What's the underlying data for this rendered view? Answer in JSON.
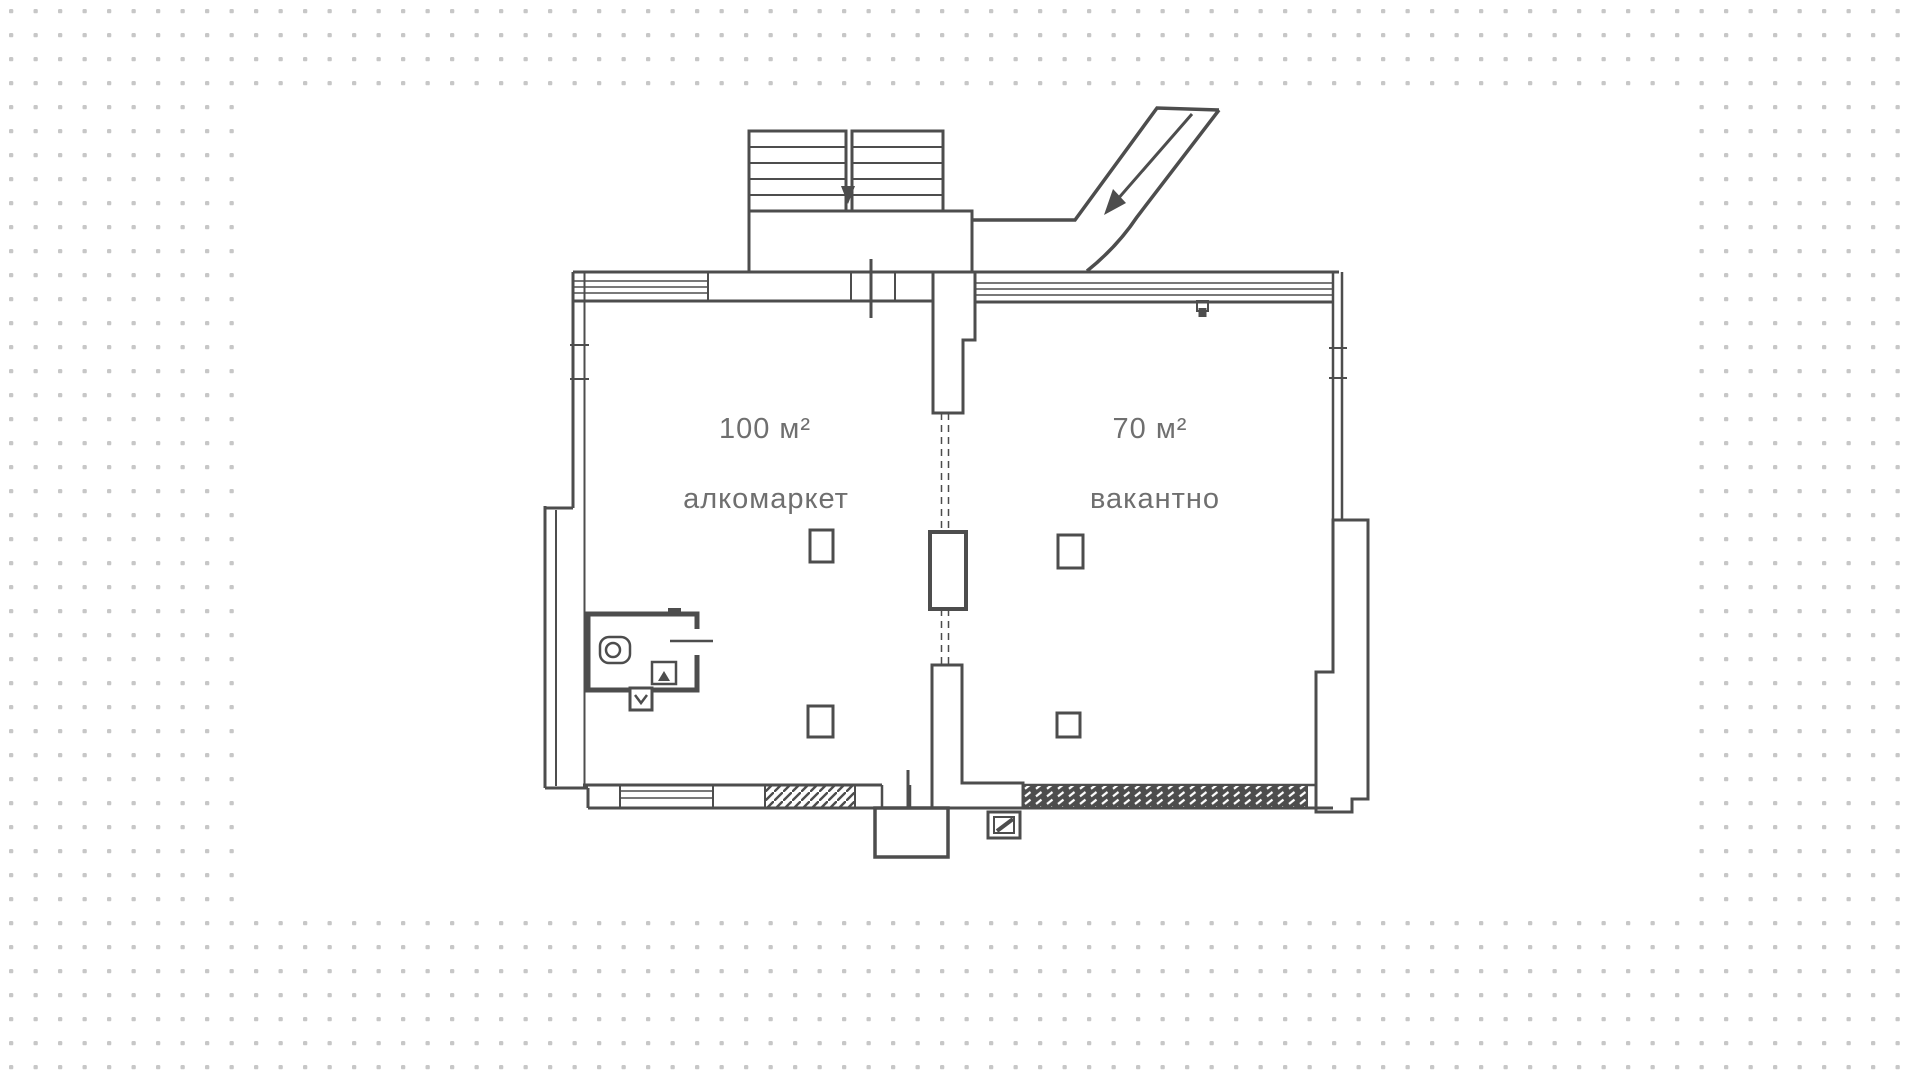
{
  "canvas": {
    "paper_color": "#ffffff",
    "dot_color": "#c7c7c7",
    "line_color": "#4d4d4d",
    "label_color": "#6f6f6f"
  },
  "floor_plan": {
    "units": [
      {
        "area_label": "100 м²",
        "name_label": "алкомаркет"
      },
      {
        "area_label": "70 м²",
        "name_label": "вакантно"
      }
    ],
    "icons": {
      "stairs": "stairs-icon",
      "entrance_arrow": "arrow-down-left-icon",
      "toilet": "toilet-icon",
      "sink": "sink-icon"
    }
  }
}
